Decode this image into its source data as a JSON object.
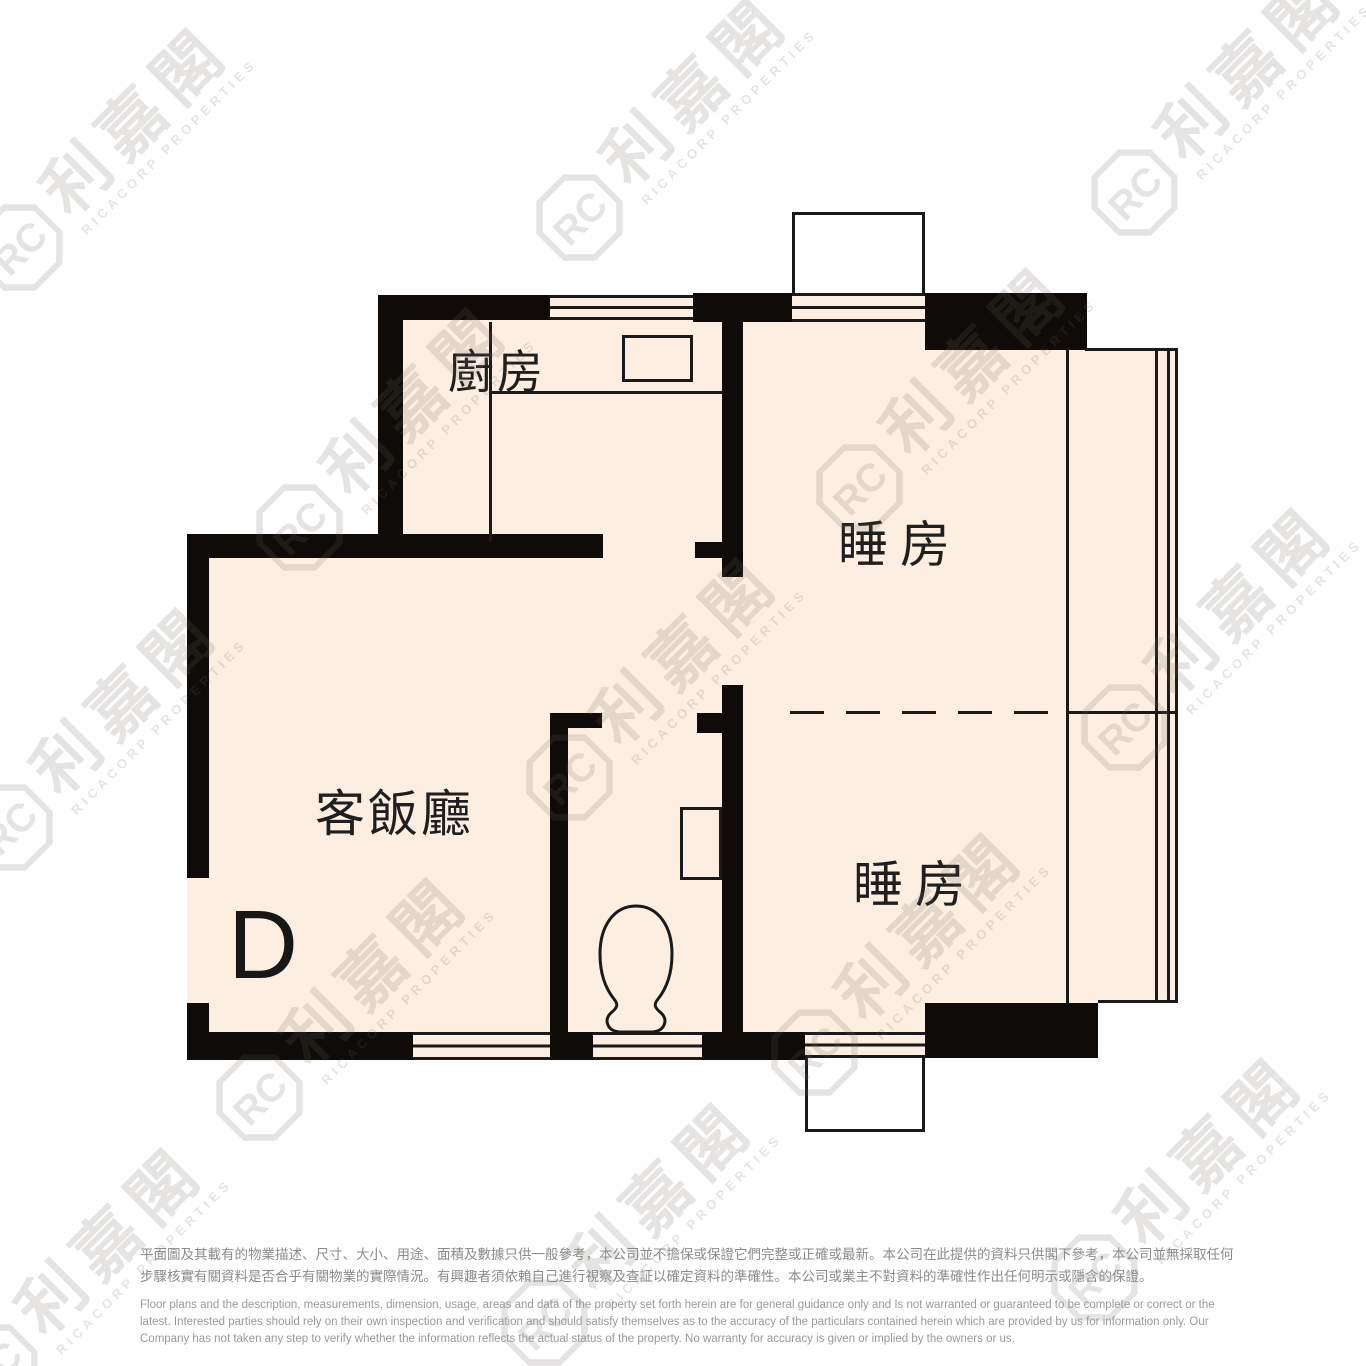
{
  "floor_plan": {
    "unit_label": "D",
    "rooms": [
      {
        "id": "kitchen",
        "label": "廚房"
      },
      {
        "id": "bedroom_top",
        "label": "睡房"
      },
      {
        "id": "bedroom_bottom",
        "label": "睡房"
      },
      {
        "id": "living_dining",
        "label": "客飯廳"
      }
    ]
  },
  "watermark": {
    "brand_cn": "利嘉閣",
    "brand_en": "RICACORP PROPERTIES",
    "logo_text": "RC"
  },
  "disclaimer": {
    "zh": "平面圖及其載有的物業描述、尺寸、大小、用途、面積及數據只供一般參考，本公司並不擔保或保證它們完整或正確或最新。本公司在此提供的資料只供閣下參考，本公司並無採取任何步驟核實有關資料是否合乎有關物業的實際情況。有興趣者須依賴自己進行視察及查証以確定資料的準確性。本公司或業主不對資料的準確性作出任何明示或隱含的保證。",
    "en": "Floor plans and the description, measurements, dimension, usage, areas and data of the property set forth herein are for general guidance only and Is not warranted or guaranteed to be complete or correct or the latest. Interested parties should rely on their own inspection and verification and should satisfy themselves as to the accuracy of the particulars contained herein which are provided by us for information only.  Our Company has not taken any step to verify whether the information reflects the actual status of the property.  No warranty for accuracy is given or implied by the owners or us."
  },
  "colors": {
    "wall": "#0e0b08",
    "floor": "#fcefe1",
    "outline": "#1a1a1a",
    "bay_window_fill": "#ffffff",
    "watermark": "#6f675e",
    "disclaimer_zh": "#8b8b8b",
    "disclaimer_en": "#999999"
  }
}
